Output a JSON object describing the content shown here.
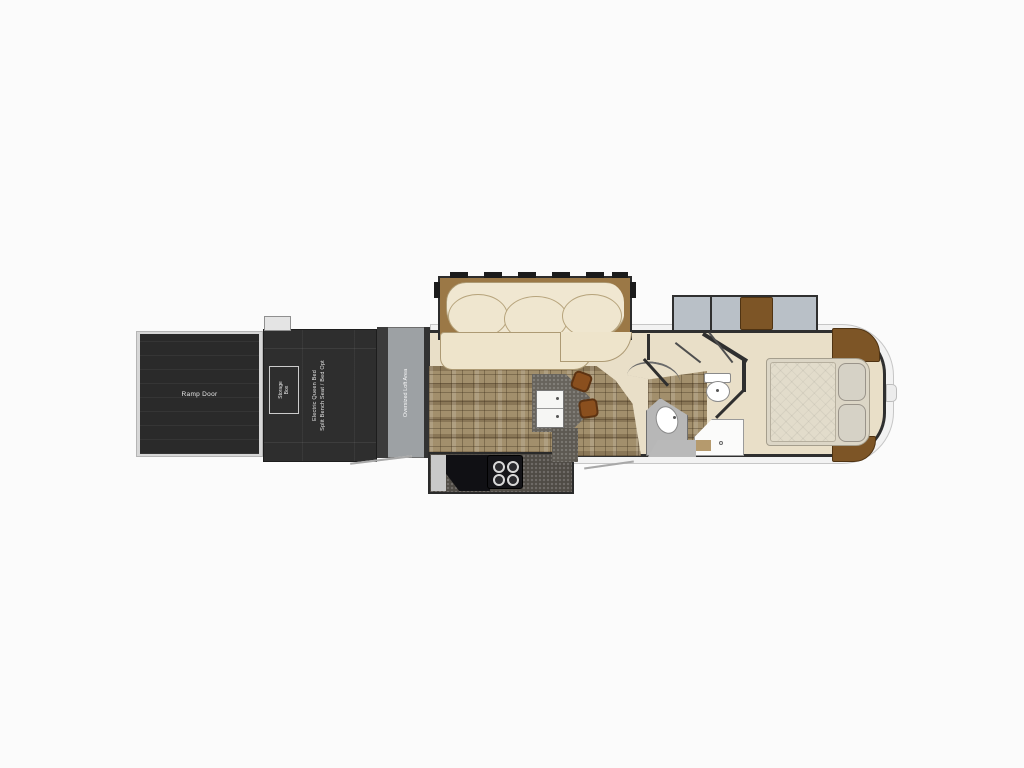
{
  "labels": {
    "ramp_door": "Ramp Door",
    "storage_box_line1": "Storage",
    "storage_box_line2": "Box",
    "garage_line1": "Electric Queen Bed",
    "garage_line2": "Split Bench Seat / Bed Opt",
    "loft": "Oversized Loft Area"
  },
  "colors": {
    "background": "#fbfbfb",
    "garage_dark": "#2e2e2e",
    "ramp_dark": "#2a2a2a",
    "loft_gray": "#9da1a4",
    "floor_cream": "#e9dfc8",
    "tile_brown": "#a28f6c",
    "slide_frame_tan": "#9b7846",
    "sofa_cream": "#f0e7d1",
    "island_gray": "#67635c",
    "counter_dark": "#4f4b45",
    "stool_brown": "#8a4f1e",
    "cabinet_brown": "#7d5526",
    "bedroom_slide_gray": "#b9c0c7",
    "bed_beige": "#dcd6c6",
    "wall_dark": "#2f2f2f",
    "fixture_white": "#ffffff",
    "cap_white": "#f2f2f2"
  }
}
